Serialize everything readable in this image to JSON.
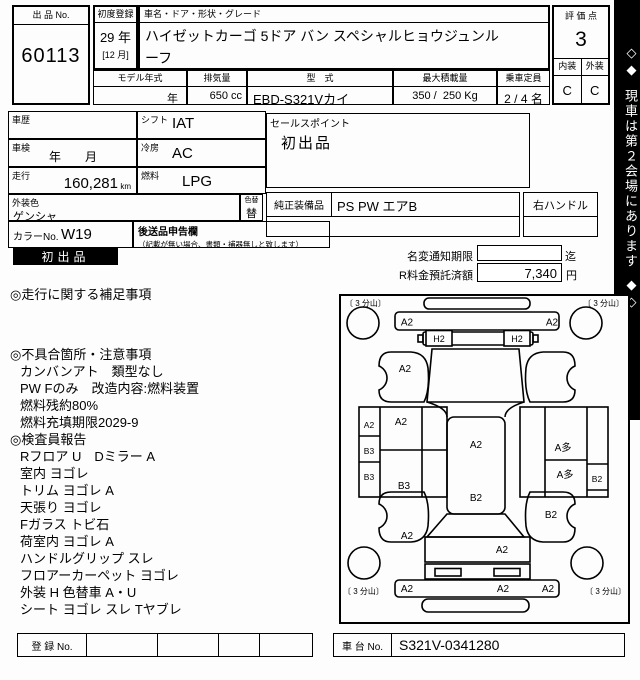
{
  "colors": {
    "line": "#000000",
    "badge_bg": "#000000",
    "banner_bg": "#000000",
    "paper": "#fdfdfd"
  },
  "header": {
    "auction_no_label": "出 品 No.",
    "auction_no": "60113",
    "first_reg_label": "初度登録",
    "first_reg_year": "29 年",
    "first_reg_month": "[12 月]",
    "name_label": "車名・ドア・形状・グレード",
    "name_line1": "ハイゼットカーゴ 5ドア バン スペシャルヒョウジュンル",
    "name_line2": "ーフ",
    "model_year_label": "モデル年式",
    "model_year_value": "年",
    "displacement_label": "排気量",
    "displacement_value": "650 cc",
    "model_code_label": "型　式",
    "model_code_value": "EBD-S321Vカイ",
    "max_load_label": "最大積載量",
    "max_load_value": "350 /  250 Kg",
    "capacity_label": "乗車定員",
    "capacity_value": "2 / 4 名",
    "score_label": "評 価 点",
    "score": "3",
    "interior_label": "内装",
    "exterior_label": "外装",
    "interior_grade": "C",
    "exterior_grade": "C"
  },
  "banner": {
    "top_marks": "◇◆",
    "text": "現車は第２会場にあります",
    "bottom_marks": "◆◇"
  },
  "info": {
    "history_label": "車歴",
    "shift_label": "シフト",
    "shift_value": "IAT",
    "inspection_label": "車検",
    "inspection_value": "年　　月",
    "ac_label": "冷房",
    "ac_value": "AC",
    "mileage_label": "走行",
    "mileage_value": "160,281",
    "mileage_unit": "km",
    "fuel_label": "燃料",
    "fuel_value": "LPG",
    "color_label": "外装色",
    "color_value": "ゲンシャ",
    "color_change_label": "色替",
    "color_change_value": "替",
    "sales_point_label": "セールスポイント",
    "sales_point_value": "初出品",
    "equipment_label": "純正装備品",
    "equipment_value": "PS PW エアB",
    "handle_value": "右ハンドル",
    "color_no_label": "カラーNo.",
    "color_no_value": "W19",
    "later_items_label": "後送品申告欄",
    "later_items_note": "（記載が無い場合、書類・補器無しと致します）",
    "badge": "初出品",
    "name_change_label": "名変通知期限",
    "name_change_suffix": "迄",
    "recycle_label": "R料金預託済額",
    "recycle_value": "7,340",
    "recycle_unit": "円"
  },
  "notes": {
    "mileage_notes_title": "◎走行に関する補足事項",
    "defects_title": "◎不具合箇所・注意事項",
    "defects": [
      "カンバンアト　類型なし",
      "PW Fのみ　改造内容:燃料装置",
      "燃料残約80%",
      "燃料充填期限2029-9"
    ],
    "inspector_title": "◎検査員報告",
    "inspector": [
      "Rフロア U　Dミラー A",
      "室内 ヨゴレ",
      "トリム ヨゴレ A",
      "天張り ヨゴレ",
      "Fガラス トビ石",
      "荷室内 ヨゴレ A",
      "ハンドルグリップ スレ",
      "フロアーカーペット ヨゴレ",
      "外装 H 色替車 A・U",
      "シート ヨゴレ スレ Tヤブレ"
    ]
  },
  "diagram": {
    "corner_front_left": "〔 3 分山〕",
    "corner_front_right": "〔 3 分山〕",
    "corner_rear_left": "〔 3 分山〕",
    "corner_rear_right": "〔 3 分山〕",
    "front_bumper_left": "A2",
    "front_bumper_right": "A2",
    "headlamp_left": "H2",
    "headlamp_right": "H2",
    "fender_front_left": "A2",
    "side_left_strip_1": "A2",
    "side_left_strip_2": "B3",
    "side_left_strip_3": "B3",
    "door_left_top": "A2",
    "door_left_bottom": "B3",
    "roof_front": "A2",
    "roof_rear": "B2",
    "door_right_top": "A多",
    "door_right_mid": "A多",
    "side_right_strip": "B2",
    "door_right_bottom": "B2",
    "fender_rear_left": "A2",
    "rear_panel": "A2",
    "rear_bumper_left": "A2",
    "rear_bumper_center": "A2",
    "rear_bumper_right": "A2"
  },
  "footer": {
    "reg_no_label": "登 録 No.",
    "chassis_label": "車 台 No.",
    "chassis_value": "S321V-0341280"
  }
}
